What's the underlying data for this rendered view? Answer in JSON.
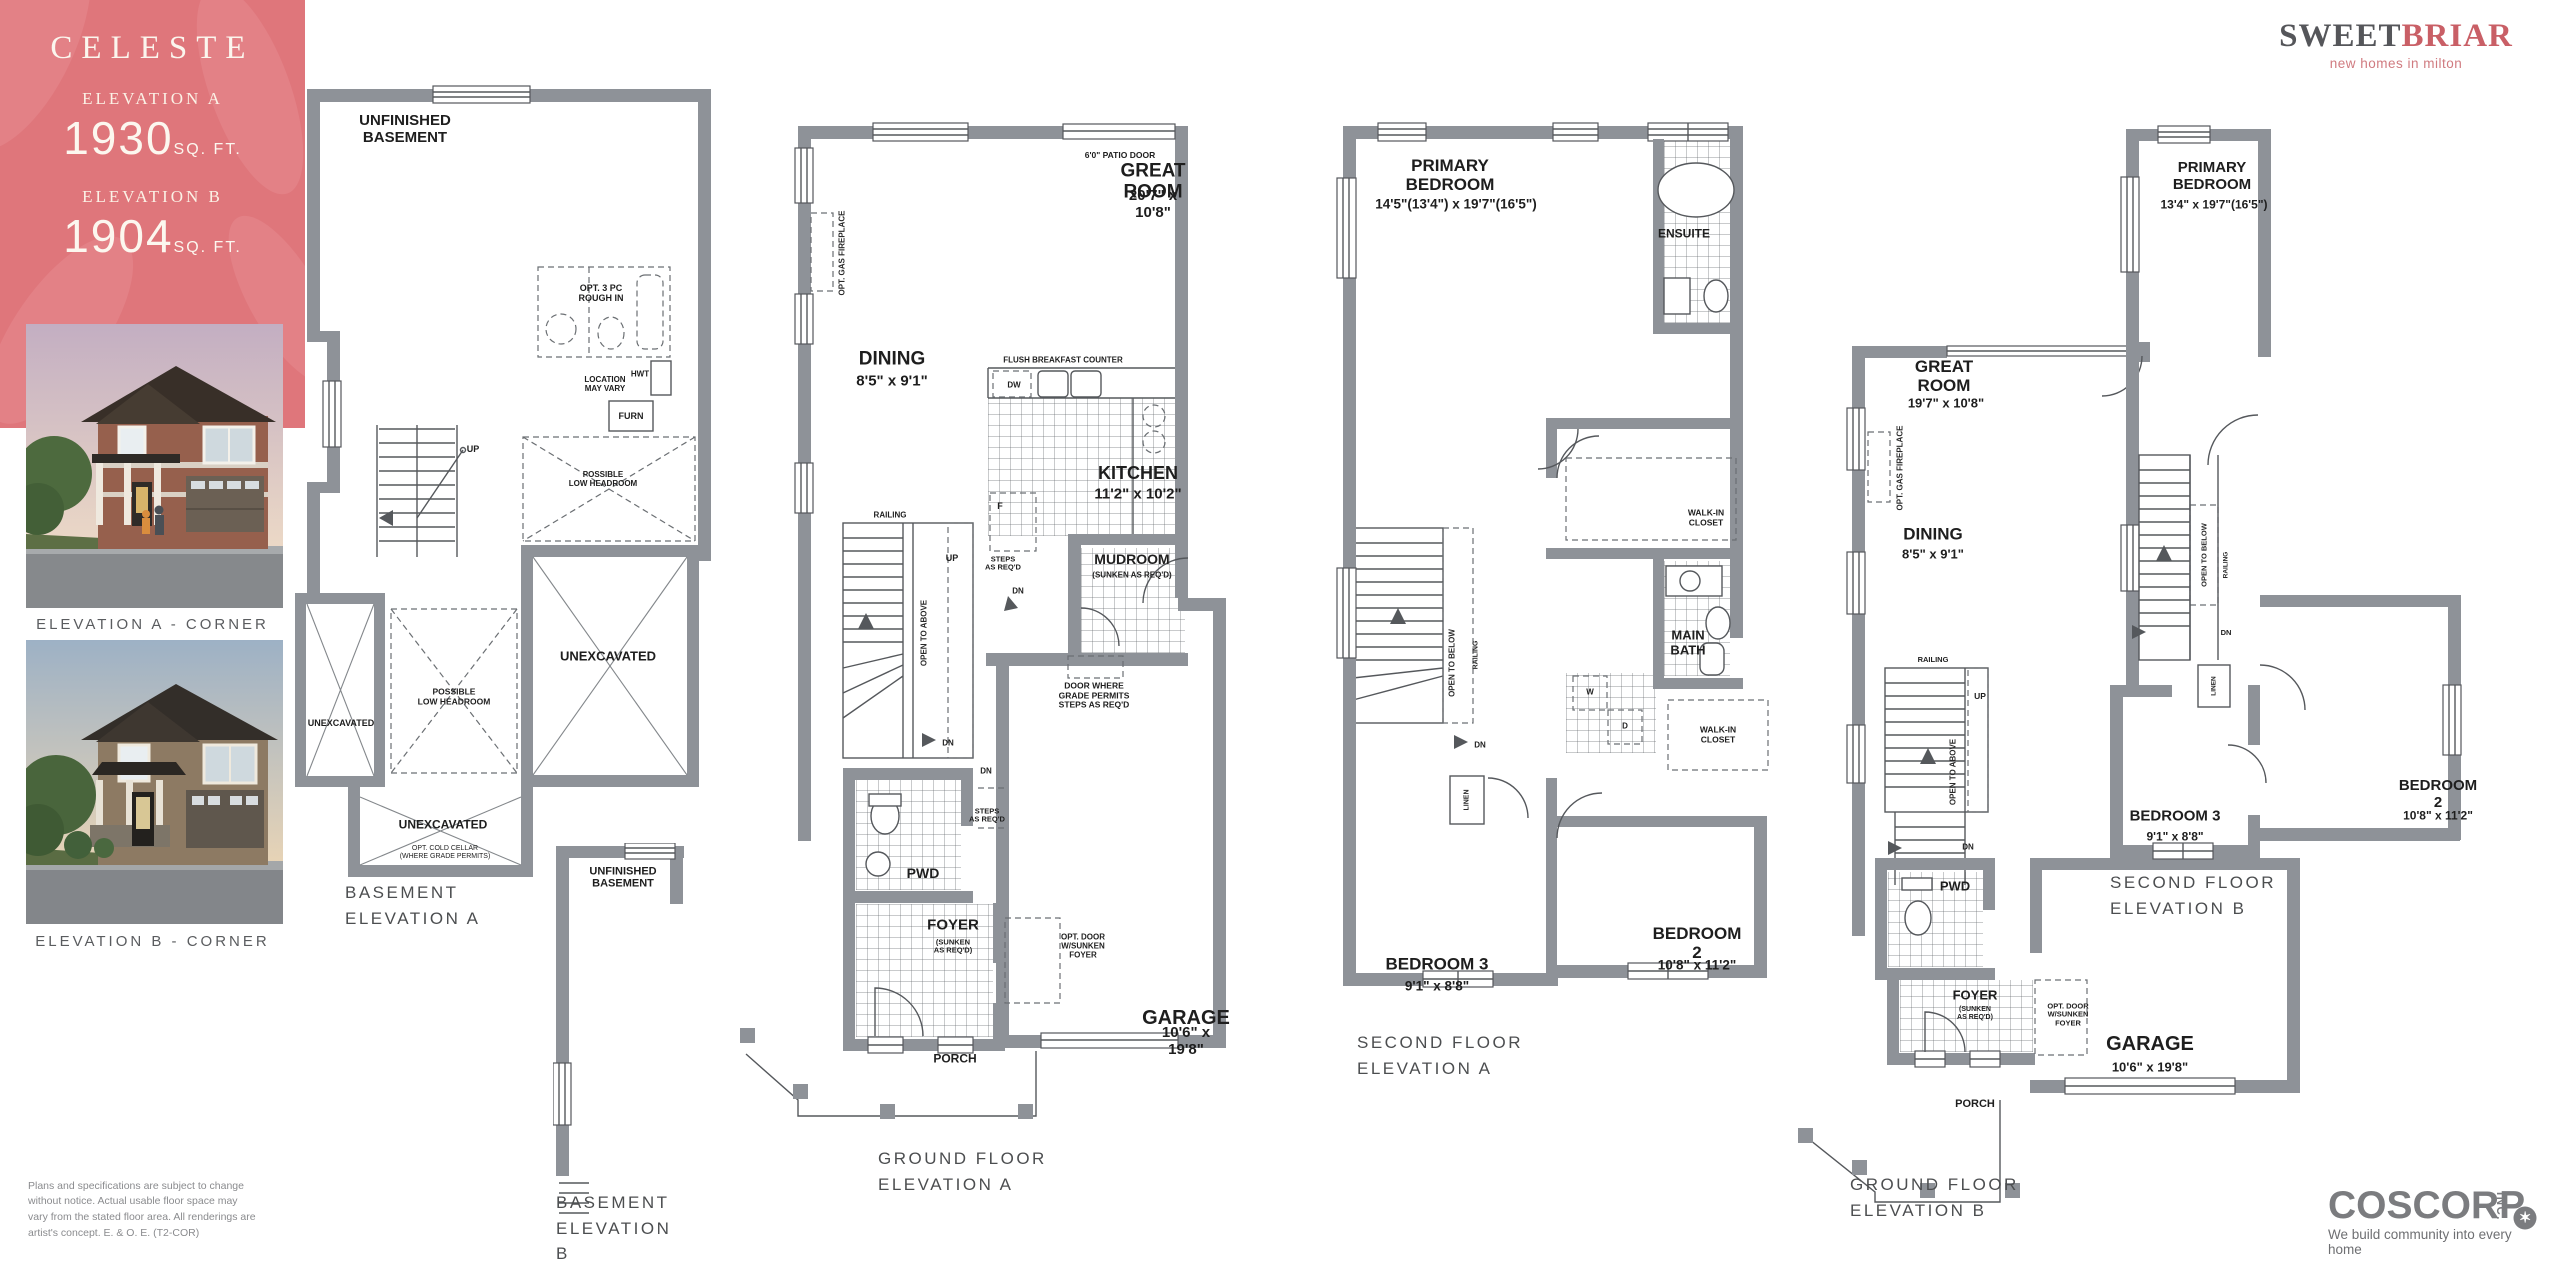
{
  "header": {
    "model_name": "CELESTE",
    "elevation_a_label": "ELEVATION A",
    "elevation_a_sqft": "1930",
    "elevation_b_label": "ELEVATION B",
    "elevation_b_sqft": "1904",
    "sqft_unit": "SQ. FT.",
    "panel_color": "#df767b"
  },
  "brand": {
    "name_part1": "SWEET",
    "name_part2": "BRIAR",
    "tagline": "new homes in milton"
  },
  "renders": {
    "caption_a": "ELEVATION A - CORNER",
    "caption_b": "ELEVATION B - CORNER"
  },
  "disclaimer": "Plans and specifications are subject to change without notice. Actual usable floor space may vary from the stated floor area. All renderings are artist's concept. E. & O. E. (T2-COR)",
  "builder": {
    "name": "COSCORP",
    "suffix": "INC.",
    "tagline": "We build community into every home"
  },
  "plans": {
    "basement_a": {
      "caption": "BASEMENT\nELEVATION A",
      "labels": {
        "unfinished": "UNFINISHED\nBASEMENT",
        "opt_rough_in": "OPT. 3 PC\nROUGH IN",
        "location": "LOCATION\nMAY VARY",
        "hwt": "HWT",
        "furn": "FURN",
        "up": "UP",
        "low_headroom_upper": "POSSIBLE\nLOW HEADROOM",
        "low_headroom_center": "POSSIBLE\nLOW HEADROOM",
        "unex_left": "UNEXCAVATED",
        "unex_right": "UNEXCAVATED",
        "unex_bottom": "UNEXCAVATED",
        "cold_cellar": "OPT. COLD CELLAR\n(WHERE GRADE PERMITS)"
      }
    },
    "basement_b": {
      "caption": "BASEMENT\nELEVATION B",
      "labels": {
        "unfinished": "UNFINISHED\nBASEMENT"
      }
    },
    "ground_a": {
      "caption": "GROUND FLOOR\nELEVATION A",
      "labels": {
        "patio_door": "6'0\" PATIO DOOR",
        "great_room": "GREAT ROOM",
        "great_room_dim": "20'7\" x 10'8\"",
        "fireplace": "OPT. GAS FIREPLACE",
        "dining": "DINING",
        "dining_dim": "8'5\" x 9'1\"",
        "breakfast": "FLUSH BREAKFAST COUNTER",
        "dw": "DW",
        "kitchen": "KITCHEN",
        "kitchen_dim": "11'2\" x 10'2\"",
        "fridge": "F",
        "railing": "RAILING",
        "up": "UP",
        "open_above": "OPEN TO ABOVE",
        "steps1": "STEPS\nAS REQ'D",
        "dn1": "DN",
        "mudroom": "MUDROOM",
        "mudroom_sub": "(SUNKEN AS REQ'D)",
        "door_grade": "DOOR WHERE\nGRADE PERMITS\nSTEPS AS REQ'D",
        "dn2": "DN",
        "dn3": "DN",
        "steps2": "STEPS\nAS REQ'D",
        "pwd": "PWD",
        "foyer": "FOYER",
        "foyer_sub": "(SUNKEN\nAS REQ'D)",
        "opt_door": "OPT. DOOR\nW/SUNKEN\nFOYER",
        "garage": "GARAGE",
        "garage_dim": "10'6\" x 19'8\"",
        "porch": "PORCH"
      }
    },
    "second_a": {
      "caption": "SECOND FLOOR\nELEVATION A",
      "labels": {
        "primary": "PRIMARY\nBEDROOM",
        "primary_dim": "14'5\"(13'4\") x 19'7\"(16'5\")",
        "ensuite": "ENSUITE",
        "wic1": "WALK-IN\nCLOSET",
        "main_bath": "MAIN\nBATH",
        "open_below": "OPEN TO BELOW",
        "railing": "RAILING",
        "washer": "W",
        "dryer": "D",
        "wic2": "WALK-IN\nCLOSET",
        "dn": "DN",
        "linen": "LINEN",
        "bedroom3": "BEDROOM 3",
        "bedroom3_dim": "9'1\" x 8'8\"",
        "bedroom2": "BEDROOM 2",
        "bedroom2_dim": "10'8\" x 11'2\""
      }
    },
    "ground_b": {
      "caption": "GROUND FLOOR\nELEVATION B",
      "labels": {
        "great_room": "GREAT\nROOM",
        "great_room_dim": "19'7\" x 10'8\"",
        "fireplace": "OPT. GAS FIREPLACE",
        "dining": "DINING",
        "dining_dim": "8'5\" x 9'1\"",
        "railing": "RAILING",
        "up": "UP",
        "open_above": "OPEN TO ABOVE",
        "dn": "DN",
        "pwd": "PWD",
        "foyer": "FOYER",
        "foyer_sub": "(SUNKEN\nAS REQ'D)",
        "opt_door": "OPT. DOOR\nW/SUNKEN\nFOYER",
        "garage": "GARAGE",
        "garage_dim": "10'6\" x 19'8\"",
        "porch": "PORCH"
      }
    },
    "second_b": {
      "caption": "SECOND FLOOR\nELEVATION B",
      "labels": {
        "primary": "PRIMARY\nBEDROOM",
        "primary_dim": "13'4\" x 19'7\"(16'5\")",
        "open_below": "OPEN TO BELOW",
        "railing": "RAILING",
        "dn": "DN",
        "linen": "LINEN",
        "bedroom3": "BEDROOM 3",
        "bedroom3_dim": "9'1\" x 8'8\"",
        "bedroom2": "BEDROOM 2",
        "bedroom2_dim": "10'8\" x 11'2\""
      }
    }
  }
}
